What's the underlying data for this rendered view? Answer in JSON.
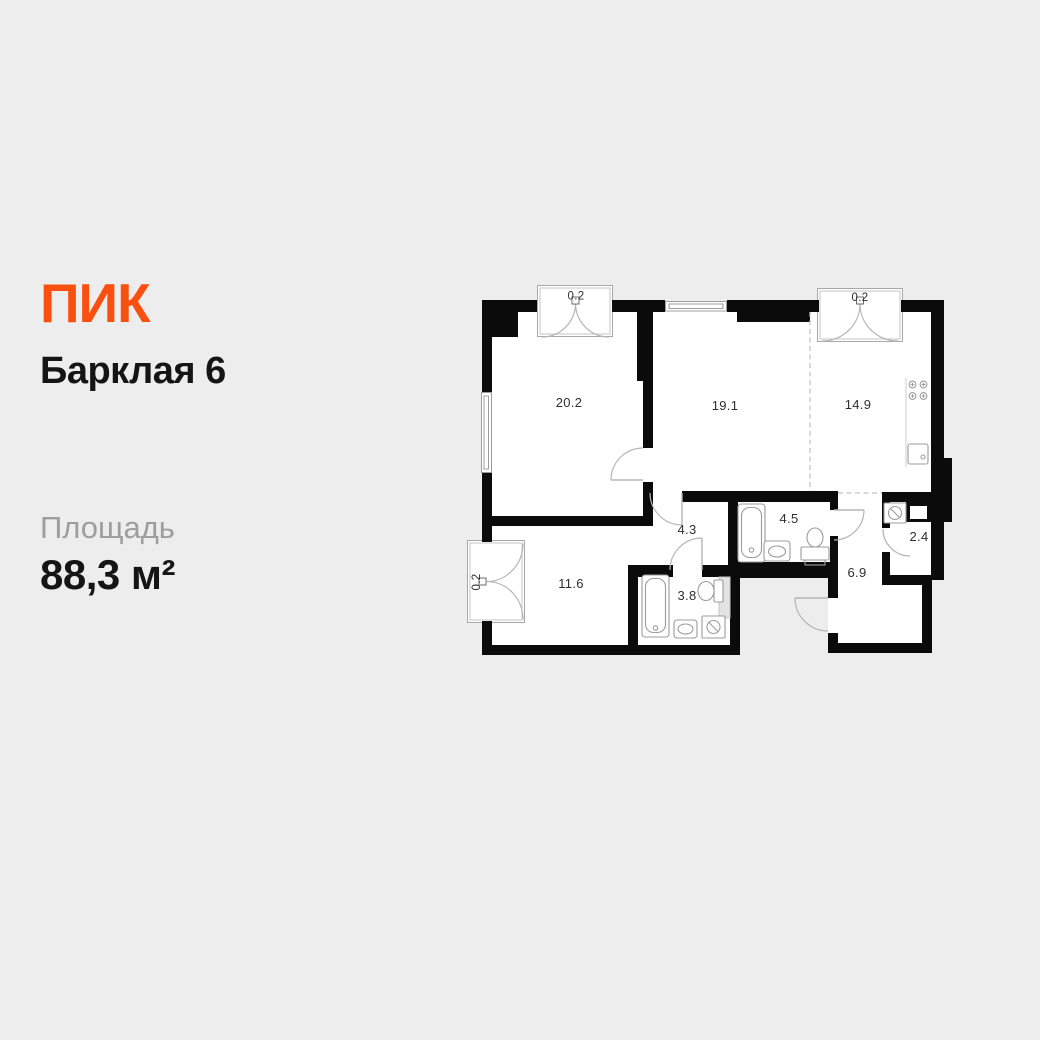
{
  "page": {
    "background_color": "#EDEDED"
  },
  "brand": {
    "logo_text": "ПИК",
    "logo_color": "#F9500F"
  },
  "listing": {
    "title": "Барклая 6",
    "area_label": "Площадь",
    "area_value": "88,3 м²"
  },
  "plan": {
    "wall_color": "#0B0B0B",
    "rooms": [
      {
        "id": "living-room",
        "area": "20.2"
      },
      {
        "id": "bedroom",
        "area": "19.1"
      },
      {
        "id": "kitchen",
        "area": "14.9"
      },
      {
        "id": "corridor",
        "area": "4.3"
      },
      {
        "id": "bathroom",
        "area": "4.5"
      },
      {
        "id": "wardrobe",
        "area": "2.4"
      },
      {
        "id": "hallway",
        "area": "6.9"
      },
      {
        "id": "bedroom-2",
        "area": "11.6"
      },
      {
        "id": "bathroom-2",
        "area": "3.8"
      }
    ],
    "balconies": [
      {
        "id": "balcony-top-left",
        "area": "0.2"
      },
      {
        "id": "balcony-top-right",
        "area": "0.2"
      },
      {
        "id": "balcony-left",
        "area": "0.2"
      }
    ],
    "icons": [
      "bathtub-icon",
      "toilet-icon",
      "sink-icon",
      "stove-burners-icon",
      "kitchen-sink-icon",
      "washing-machine-icon",
      "ventilation-duct-icon",
      "door-swing-icon",
      "window-icon"
    ]
  }
}
